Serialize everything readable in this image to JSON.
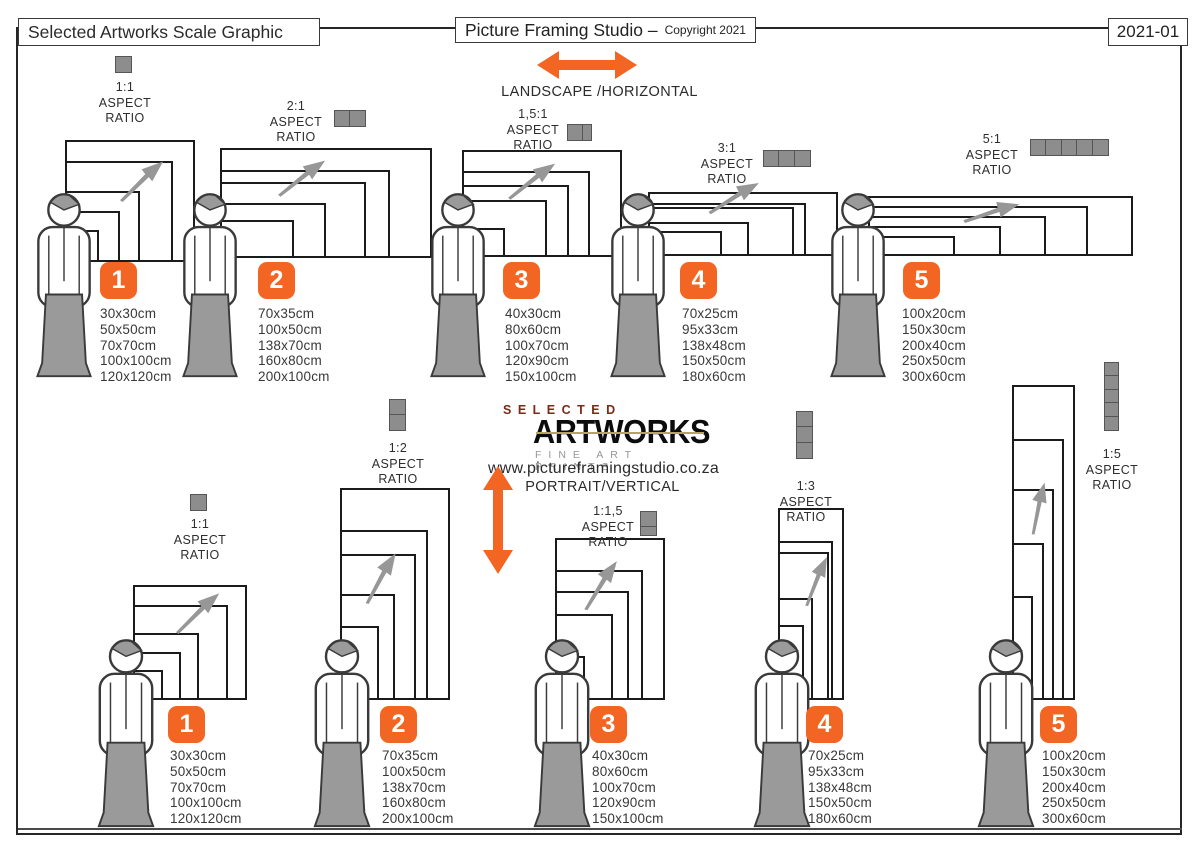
{
  "header": {
    "left_title": "Selected Artworks Scale Graphic",
    "center_title": "Picture Framing Studio –",
    "center_suffix": "Copyright 2021",
    "doc_number": "2021-01"
  },
  "labels": {
    "aspect": "ASPECT",
    "ratio": "RATIO"
  },
  "colors": {
    "accent_orange": "#F26522",
    "icon_gray": "#8D8D8D",
    "figure_gray": "#9A9A9A",
    "outline": "#1B1B1B"
  },
  "landscape": {
    "direction_label": "LANDSCAPE /HORIZONTAL",
    "groups": [
      {
        "number": "1",
        "ratio": "1:1",
        "sizes": [
          "30x30cm",
          "50x50cm",
          "70x70cm",
          "100x100cm",
          "120x120cm"
        ]
      },
      {
        "number": "2",
        "ratio": "2:1",
        "sizes": [
          "70x35cm",
          "100x50cm",
          "138x70cm",
          "160x80cm",
          "200x100cm"
        ]
      },
      {
        "number": "3",
        "ratio": "1,5:1",
        "sizes": [
          "40x30cm",
          "80x60cm",
          "100x70cm",
          "120x90cm",
          "150x100cm"
        ]
      },
      {
        "number": "4",
        "ratio": "3:1",
        "sizes": [
          "70x25cm",
          "95x33cm",
          "138x48cm",
          "150x50cm",
          "180x60cm"
        ]
      },
      {
        "number": "5",
        "ratio": "5:1",
        "sizes": [
          "100x20cm",
          "150x30cm",
          "200x40cm",
          "250x50cm",
          "300x60cm"
        ]
      }
    ]
  },
  "portrait": {
    "direction_label": "PORTRAIT/VERTICAL",
    "website": "www.pictureframingstudio.co.za",
    "logo": {
      "top": "SELECTED",
      "main": "ARTWORKS",
      "sub": "FINE ART PRINTS"
    },
    "groups": [
      {
        "number": "1",
        "ratio": "1:1",
        "sizes": [
          "30x30cm",
          "50x50cm",
          "70x70cm",
          "100x100cm",
          "120x120cm"
        ]
      },
      {
        "number": "2",
        "ratio": "1:2",
        "sizes": [
          "70x35cm",
          "100x50cm",
          "138x70cm",
          "160x80cm",
          "200x100cm"
        ]
      },
      {
        "number": "3",
        "ratio": "1:1,5",
        "sizes": [
          "40x30cm",
          "80x60cm",
          "100x70cm",
          "120x90cm",
          "150x100cm"
        ]
      },
      {
        "number": "4",
        "ratio": "1:3",
        "sizes": [
          "70x25cm",
          "95x33cm",
          "138x48cm",
          "150x50cm",
          "180x60cm"
        ]
      },
      {
        "number": "5",
        "ratio": "1:5",
        "sizes": [
          "100x20cm",
          "150x30cm",
          "200x40cm",
          "250x50cm",
          "300x60cm"
        ]
      }
    ]
  }
}
